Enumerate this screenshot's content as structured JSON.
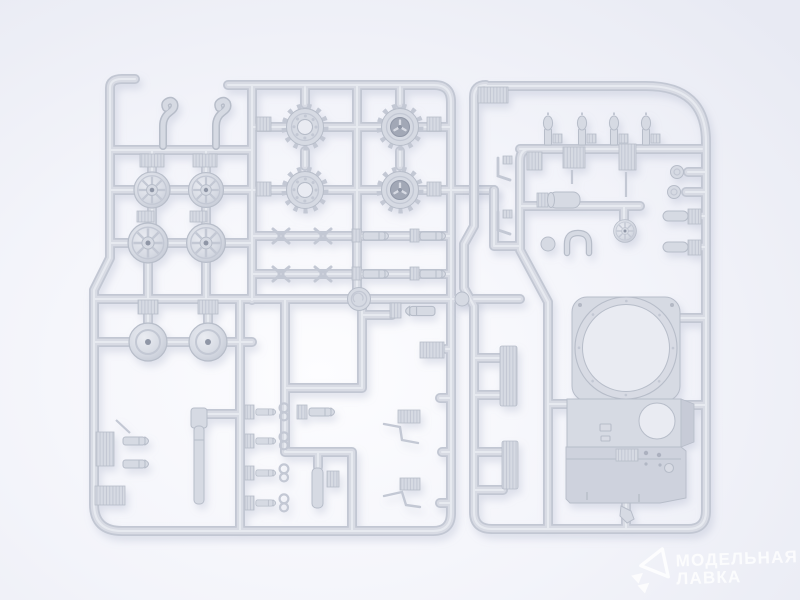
{
  "scene": {
    "subject": "Photograph of two light-gray injection-molded styrene sprues (model kit part frames) of an armored vehicle kit laid on a bright white background",
    "left_sprue_contents": "fenders, spoked road wheels, toothed drive sprockets, domed idler wheels, gun barrel, tow shackles, track links and small fittings",
    "right_sprue_contents": "periscopes, hatches, vent grilles, brackets, small wheels and a large hull superstructure piece with a circular turret-ring opening",
    "mold_stamp": "circular manufacturer stamp embossed on runner"
  },
  "watermark": {
    "line1": "МОДЕЛЬНАЯ",
    "line2": "ЛАВКА"
  },
  "colors": {
    "bg_center": "#fdfdff",
    "bg_mid": "#f3f4fa",
    "bg_edge": "#e8eaf3",
    "runner_edge": "#c2c7d3",
    "runner_face": "#d8dbe4",
    "runner_highlight": "#eaecf2",
    "part_fill": "#d6dae3",
    "part_stroke": "#b7bdc9",
    "part_detail": "#c3c8d4",
    "hole_fill": "#e9ebf2",
    "dark_accent": "#8f96a6",
    "sprocket_hub": "#a2a8b6",
    "side_shade": "#c7cbd7",
    "front_plate": "#ced2dd",
    "shadow": "#9aa2bc",
    "watermark_white": "#ffffff"
  }
}
